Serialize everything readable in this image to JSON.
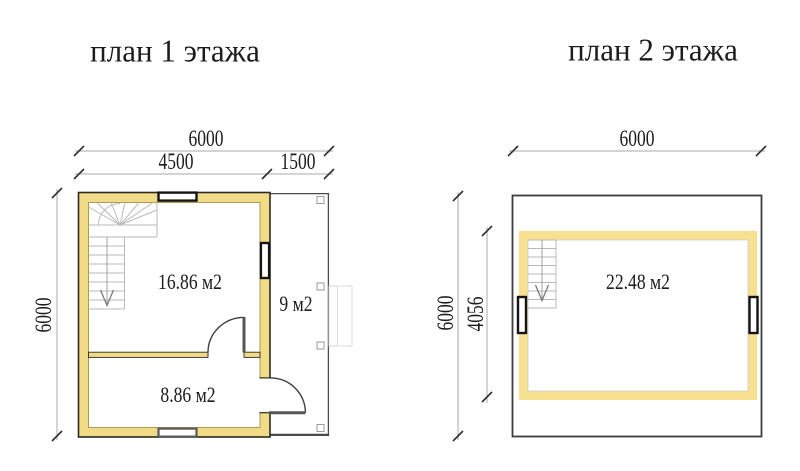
{
  "colors": {
    "wall_fill_floor1": "#F2DB86",
    "wall_fill_floor2": "#F7E08F",
    "wall_outline": "#2B2A23",
    "wall_inner_edge": "#A5914F",
    "window_frame_dark": "#141414",
    "window_frame_gray": "#5A5A5A",
    "dim_line": "#A8A8A8",
    "dim_tick": "#2E2E2E",
    "door_line": "#3F3F3F",
    "stair_line": "#B9B9B9",
    "text": "#1C1C1C"
  },
  "floor1": {
    "title": "план 1 этажа",
    "dimensions": {
      "total_width_mm": "6000",
      "house_width_mm": "4500",
      "porch_width_mm": "1500",
      "total_depth_mm": "6000"
    },
    "rooms": [
      {
        "area_label": "16.86 м2"
      },
      {
        "area_label": "9 м2"
      },
      {
        "area_label": "8.86 м2"
      }
    ]
  },
  "floor2": {
    "title": "план 2 этажа",
    "dimensions": {
      "total_width_mm": "6000",
      "total_depth_mm": "6000",
      "room_depth_mm": "4056"
    },
    "rooms": [
      {
        "area_label": "22.48 м2"
      }
    ]
  }
}
